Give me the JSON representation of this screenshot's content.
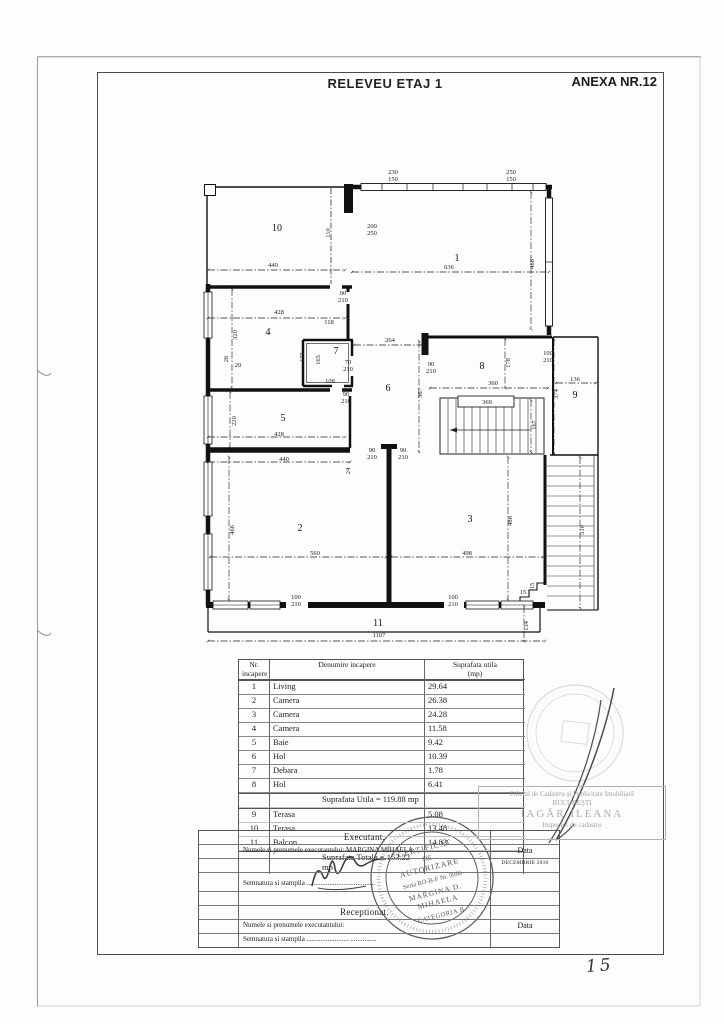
{
  "header": {
    "title": "RELEVEU ETAJ 1",
    "annex": "ANEXA NR.12"
  },
  "plan": {
    "labels": [
      {
        "t": "1",
        "x": 457,
        "y": 261,
        "c": "room"
      },
      {
        "t": "2",
        "x": 300,
        "y": 531,
        "c": "room"
      },
      {
        "t": "3",
        "x": 470,
        "y": 522,
        "c": "room"
      },
      {
        "t": "4",
        "x": 268,
        "y": 335,
        "c": "room"
      },
      {
        "t": "5",
        "x": 283,
        "y": 421,
        "c": "room"
      },
      {
        "t": "6",
        "x": 388,
        "y": 391,
        "c": "room"
      },
      {
        "t": "7",
        "x": 336,
        "y": 354,
        "c": "room"
      },
      {
        "t": "8",
        "x": 482,
        "y": 369,
        "c": "room"
      },
      {
        "t": "9",
        "x": 575,
        "y": 398,
        "c": "room"
      },
      {
        "t": "10",
        "x": 277,
        "y": 231,
        "c": "room"
      },
      {
        "t": "11",
        "x": 378,
        "y": 626,
        "c": "room"
      },
      {
        "t": "230",
        "x": 393,
        "y": 174
      },
      {
        "t": "150",
        "x": 393,
        "y": 181
      },
      {
        "t": "250",
        "x": 511,
        "y": 174
      },
      {
        "t": "150",
        "x": 511,
        "y": 181
      },
      {
        "t": "200",
        "x": 372,
        "y": 228
      },
      {
        "t": "250",
        "x": 372,
        "y": 235
      },
      {
        "t": "110",
        "x": 330,
        "y": 233,
        "r": 1
      },
      {
        "t": "440",
        "x": 273,
        "y": 267
      },
      {
        "t": "636",
        "x": 449,
        "y": 269
      },
      {
        "t": "466",
        "x": 534,
        "y": 264,
        "r": 1
      },
      {
        "t": "90",
        "x": 343,
        "y": 295
      },
      {
        "t": "210",
        "x": 343,
        "y": 302
      },
      {
        "t": "428",
        "x": 279,
        "y": 314
      },
      {
        "t": "118",
        "x": 329,
        "y": 324
      },
      {
        "t": "320",
        "x": 237,
        "y": 335,
        "r": 1
      },
      {
        "t": "175",
        "x": 304,
        "y": 357,
        "r": 1
      },
      {
        "t": "165",
        "x": 320,
        "y": 360,
        "r": 1
      },
      {
        "t": "70",
        "x": 348,
        "y": 364
      },
      {
        "t": "210",
        "x": 348,
        "y": 371
      },
      {
        "t": "108",
        "x": 330,
        "y": 383
      },
      {
        "t": "264",
        "x": 390,
        "y": 342
      },
      {
        "t": "90",
        "x": 431,
        "y": 366
      },
      {
        "t": "210",
        "x": 431,
        "y": 373
      },
      {
        "t": "26",
        "x": 228,
        "y": 359,
        "r": 1
      },
      {
        "t": "20",
        "x": 238,
        "y": 367
      },
      {
        "t": "100",
        "x": 548,
        "y": 355
      },
      {
        "t": "210",
        "x": 548,
        "y": 362
      },
      {
        "t": "178",
        "x": 510,
        "y": 363,
        "r": 1
      },
      {
        "t": "136",
        "x": 575,
        "y": 381
      },
      {
        "t": "374",
        "x": 558,
        "y": 394,
        "r": 1
      },
      {
        "t": "360",
        "x": 493,
        "y": 385
      },
      {
        "t": "369",
        "x": 487,
        "y": 404
      },
      {
        "t": "367",
        "x": 422,
        "y": 393,
        "r": 1
      },
      {
        "t": "167",
        "x": 536,
        "y": 425,
        "r": 1
      },
      {
        "t": "90",
        "x": 346,
        "y": 396
      },
      {
        "t": "210",
        "x": 346,
        "y": 403
      },
      {
        "t": "220",
        "x": 236,
        "y": 421,
        "r": 1
      },
      {
        "t": "428",
        "x": 279,
        "y": 436
      },
      {
        "t": "440",
        "x": 284,
        "y": 461
      },
      {
        "t": "24",
        "x": 350,
        "y": 471,
        "r": 1
      },
      {
        "t": "90",
        "x": 372,
        "y": 452
      },
      {
        "t": "210",
        "x": 372,
        "y": 459
      },
      {
        "t": "90",
        "x": 403,
        "y": 452
      },
      {
        "t": "210",
        "x": 403,
        "y": 459
      },
      {
        "t": "466",
        "x": 234,
        "y": 530,
        "r": 1
      },
      {
        "t": "560",
        "x": 315,
        "y": 555
      },
      {
        "t": "488",
        "x": 512,
        "y": 521,
        "r": 1
      },
      {
        "t": "498",
        "x": 467,
        "y": 555
      },
      {
        "t": "100",
        "x": 296,
        "y": 599
      },
      {
        "t": "210",
        "x": 296,
        "y": 606
      },
      {
        "t": "100",
        "x": 453,
        "y": 599
      },
      {
        "t": "210",
        "x": 453,
        "y": 606
      },
      {
        "t": "15",
        "x": 523,
        "y": 594
      },
      {
        "t": "15",
        "x": 534,
        "y": 586,
        "r": 1
      },
      {
        "t": "510",
        "x": 584,
        "y": 530,
        "r": 1
      },
      {
        "t": "1107",
        "x": 379,
        "y": 637
      },
      {
        "t": "134",
        "x": 528,
        "y": 626,
        "r": 1
      }
    ]
  },
  "area_table": {
    "headers": {
      "col1a": "Nr.",
      "col1b": "incapere",
      "col2": "Denumire  incapere",
      "col3a": "Suprafata  utila",
      "col3b": "(mp)"
    },
    "rows": [
      {
        "nr": "1",
        "name": "Living",
        "area": "29.64"
      },
      {
        "nr": "2",
        "name": "Camera",
        "area": "26.38"
      },
      {
        "nr": "3",
        "name": "Camera",
        "area": "24.28"
      },
      {
        "nr": "4",
        "name": "Camera",
        "area": "11.58"
      },
      {
        "nr": "5",
        "name": "Baie",
        "area": "9.42"
      },
      {
        "nr": "6",
        "name": "Hol",
        "area": "10.39"
      },
      {
        "nr": "7",
        "name": "Debara",
        "area": "1.78"
      },
      {
        "nr": "8",
        "name": "Hol",
        "area": "6.41"
      }
    ],
    "subtotal": "Suprafata Utila  =  119.88 mp",
    "rows2": [
      {
        "nr": "9",
        "name": "Terasa",
        "area": "5.08"
      },
      {
        "nr": "10",
        "name": "Terasa",
        "area": "13.48"
      },
      {
        "nr": "11",
        "name": "Balcon",
        "area": "14.83"
      }
    ],
    "total": "Suprafata Totala  =  153.22 mp"
  },
  "form": {
    "executant_header": "Executant.",
    "executant_name": "Numele si prenumele executantului: MARGINA MIHAELA",
    "data_label": "Data",
    "date_value": "DECEMBRIE 2010",
    "signature_label": "Semnatura si stampila  .......................................",
    "receptionat_header": "Receptionat.",
    "receptionat_name": "Numele si prenumele executantului:",
    "signature_label2": "Semnatura si stampila   ........................  ..............."
  },
  "stamps": {
    "ocpi_line1": "Oficiul de Cadastru şi Publicitate Imobiliară",
    "ocpi_line2": "BUCUREŞTI",
    "ocpi_name": "IAGĂR ILEANA",
    "ocpi_role": "Inspector de cadastru",
    "cert_l1": "CERTIFICAT",
    "cert_l2": "DE",
    "cert_l3": "AUTORIZARE",
    "cert_l4": "Seria RO-B-F Nr. 0066",
    "cert_l5": "MARGINA D.",
    "cert_l6": "MIHAELA",
    "cert_l7": "CATEGORIA B"
  },
  "page_number": "15",
  "colors": {
    "ink": "#1a1a1a",
    "stamp_gray": "#9aa1ab",
    "stamp_dark": "#3c3c3c"
  }
}
